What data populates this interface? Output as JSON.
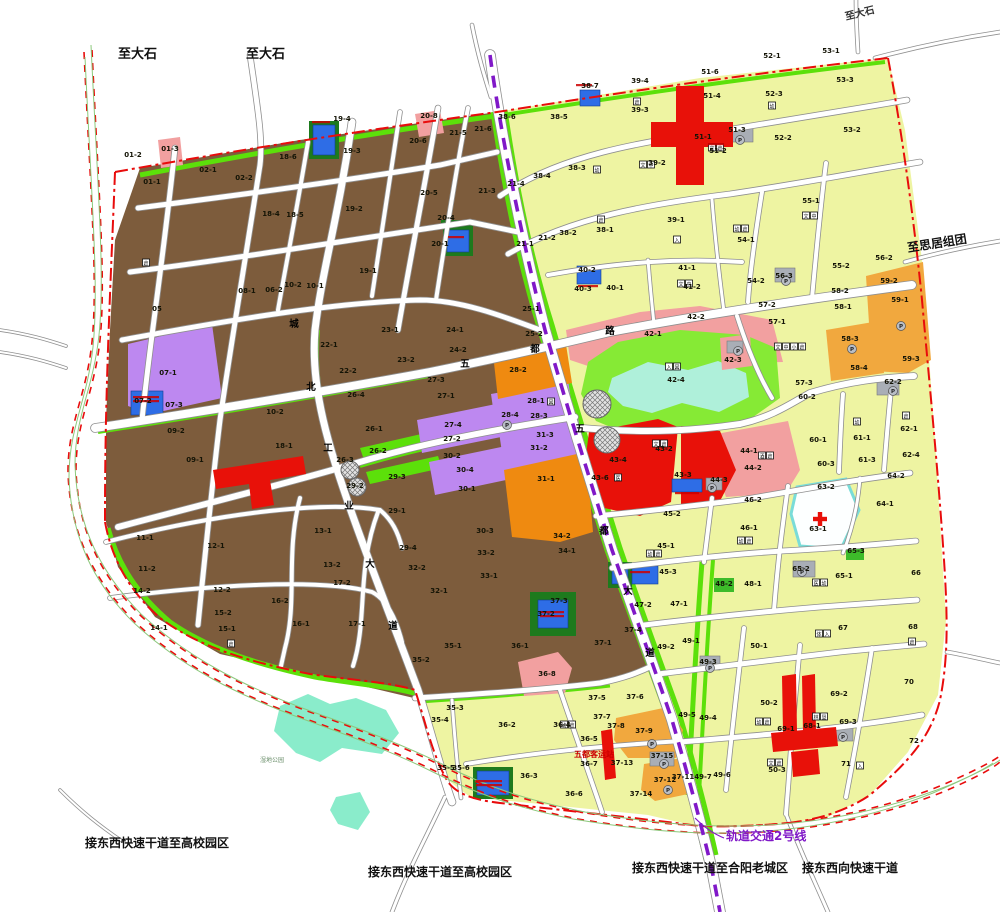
{
  "map_title": "城市控制性详细规划图",
  "colors": {
    "residential_brown": "#7d5c3c",
    "residential_yellow": "#eef4a2",
    "green_strip": "#5ce00a",
    "park_green": "#86ea35",
    "lake_cyan": "#aff0da",
    "wetland_cyan": "#8aeccb",
    "commercial_red": "#e81109",
    "orange_deep": "#ef8a10",
    "orange_light": "#f1a83e",
    "purple_parcel": "#bd88f0",
    "pink_parcel": "#f2a0a0",
    "blue_parcel": "#2e6de6",
    "gray_parcel": "#a9aeb6",
    "dark_green": "#1d7a1d",
    "hospital_white": "#fdffff",
    "hospital_border": "#7adcd8",
    "boundary_red": "#e80c0c",
    "rail_purple": "#8018c8",
    "road_casing": "#8f8f8f",
    "label_black": "#141406",
    "red_text": "#cc0000"
  },
  "exit_labels": [
    {
      "t": "至大石",
      "x": 118,
      "y": 58,
      "s": 13,
      "c": "#111",
      "r": 0
    },
    {
      "t": "至大石",
      "x": 246,
      "y": 58,
      "s": 13,
      "c": "#111",
      "r": 0
    },
    {
      "t": "至大石",
      "x": 846,
      "y": 20,
      "s": 10,
      "c": "#333",
      "r": -14
    },
    {
      "t": "至思居组团",
      "x": 908,
      "y": 252,
      "s": 12,
      "c": "#111",
      "r": -9
    },
    {
      "t": "接东西快速干道至高校园区",
      "x": 85,
      "y": 847,
      "s": 12,
      "c": "#111",
      "r": 0
    },
    {
      "t": "接东西快速干道至高校园区",
      "x": 368,
      "y": 876,
      "s": 12,
      "c": "#111",
      "r": 0
    },
    {
      "t": "接东西快速干道至合阳老城区",
      "x": 632,
      "y": 872,
      "s": 12,
      "c": "#111",
      "r": 0
    },
    {
      "t": "接东西向快速干道",
      "x": 802,
      "y": 872,
      "s": 12,
      "c": "#111",
      "r": 0
    }
  ],
  "rail_label": {
    "t": "轨道交通2号线",
    "x": 726,
    "y": 840,
    "s": 12,
    "c": "#8018c8"
  },
  "bus_station_label": {
    "t": "五都客运站",
    "x": 574,
    "y": 757,
    "s": 8,
    "c": "#cc0000"
  },
  "wetland_label": {
    "t": "湿地公园",
    "x": 260,
    "y": 762,
    "s": 6,
    "c": "#6b8f6b"
  },
  "road_name_chars": [
    {
      "t": "城",
      "x": 294,
      "y": 327
    },
    {
      "t": "北",
      "x": 311,
      "y": 390
    },
    {
      "t": "工",
      "x": 328,
      "y": 451
    },
    {
      "t": "业",
      "x": 349,
      "y": 509
    },
    {
      "t": "大",
      "x": 370,
      "y": 567
    },
    {
      "t": "道",
      "x": 393,
      "y": 629
    },
    {
      "t": "五",
      "x": 465,
      "y": 367
    },
    {
      "t": "都",
      "x": 535,
      "y": 352
    },
    {
      "t": "路",
      "x": 610,
      "y": 334
    },
    {
      "t": "五",
      "x": 580,
      "y": 432
    },
    {
      "t": "都",
      "x": 604,
      "y": 534
    },
    {
      "t": "大",
      "x": 628,
      "y": 594
    },
    {
      "t": "道",
      "x": 650,
      "y": 656
    }
  ],
  "parcel_labels": [
    {
      "t": "01-2",
      "x": 133,
      "y": 157
    },
    {
      "t": "01-3",
      "x": 170,
      "y": 151
    },
    {
      "t": "01-1",
      "x": 152,
      "y": 184
    },
    {
      "t": "02-1",
      "x": 208,
      "y": 172
    },
    {
      "t": "02-2",
      "x": 244,
      "y": 180
    },
    {
      "t": "18-6",
      "x": 288,
      "y": 159
    },
    {
      "t": "18-5",
      "x": 295,
      "y": 217
    },
    {
      "t": "18-4",
      "x": 271,
      "y": 216
    },
    {
      "t": "19-4",
      "x": 342,
      "y": 121
    },
    {
      "t": "19-3",
      "x": 352,
      "y": 153
    },
    {
      "t": "19-2",
      "x": 354,
      "y": 211
    },
    {
      "t": "19-1",
      "x": 368,
      "y": 273
    },
    {
      "t": "20-8",
      "x": 429,
      "y": 118
    },
    {
      "t": "20-6",
      "x": 418,
      "y": 143
    },
    {
      "t": "20-5",
      "x": 429,
      "y": 195
    },
    {
      "t": "20-4",
      "x": 446,
      "y": 220
    },
    {
      "t": "20-1",
      "x": 440,
      "y": 246
    },
    {
      "t": "21-5",
      "x": 458,
      "y": 135
    },
    {
      "t": "21-6",
      "x": 483,
      "y": 131
    },
    {
      "t": "21-3",
      "x": 487,
      "y": 193
    },
    {
      "t": "21-4",
      "x": 516,
      "y": 186
    },
    {
      "t": "21-1",
      "x": 525,
      "y": 246
    },
    {
      "t": "21-2",
      "x": 547,
      "y": 240
    },
    {
      "t": "05",
      "x": 157,
      "y": 311
    },
    {
      "t": "08-1",
      "x": 247,
      "y": 293
    },
    {
      "t": "06-2",
      "x": 274,
      "y": 292
    },
    {
      "t": "10-2",
      "x": 293,
      "y": 287
    },
    {
      "t": "10-1",
      "x": 315,
      "y": 288
    },
    {
      "t": "22-1",
      "x": 329,
      "y": 347
    },
    {
      "t": "22-2",
      "x": 348,
      "y": 373
    },
    {
      "t": "23-1",
      "x": 390,
      "y": 332
    },
    {
      "t": "23-2",
      "x": 406,
      "y": 362
    },
    {
      "t": "24-1",
      "x": 455,
      "y": 332
    },
    {
      "t": "24-2",
      "x": 458,
      "y": 352
    },
    {
      "t": "25-1",
      "x": 531,
      "y": 311
    },
    {
      "t": "25-2",
      "x": 534,
      "y": 336
    },
    {
      "t": "07-1",
      "x": 168,
      "y": 375
    },
    {
      "t": "07-2",
      "x": 143,
      "y": 403
    },
    {
      "t": "07-3",
      "x": 174,
      "y": 407
    },
    {
      "t": "09-2",
      "x": 176,
      "y": 433
    },
    {
      "t": "09-1",
      "x": 195,
      "y": 462
    },
    {
      "t": "10-2",
      "x": 275,
      "y": 414
    },
    {
      "t": "18-1",
      "x": 284,
      "y": 448
    },
    {
      "t": "26-4",
      "x": 356,
      "y": 397
    },
    {
      "t": "26-1",
      "x": 374,
      "y": 431
    },
    {
      "t": "26-2",
      "x": 378,
      "y": 453
    },
    {
      "t": "26-3",
      "x": 345,
      "y": 462
    },
    {
      "t": "29-3",
      "x": 397,
      "y": 479
    },
    {
      "t": "29-2",
      "x": 355,
      "y": 488
    },
    {
      "t": "27-3",
      "x": 436,
      "y": 382
    },
    {
      "t": "27-1",
      "x": 446,
      "y": 398
    },
    {
      "t": "27-4",
      "x": 453,
      "y": 427
    },
    {
      "t": "27-2",
      "x": 452,
      "y": 441
    },
    {
      "t": "28-2",
      "x": 518,
      "y": 372
    },
    {
      "t": "28-1",
      "x": 536,
      "y": 403
    },
    {
      "t": "28-4",
      "x": 510,
      "y": 417
    },
    {
      "t": "28-3",
      "x": 539,
      "y": 418
    },
    {
      "t": "31-3",
      "x": 545,
      "y": 437
    },
    {
      "t": "31-2",
      "x": 539,
      "y": 450
    },
    {
      "t": "30-2",
      "x": 452,
      "y": 458
    },
    {
      "t": "30-4",
      "x": 465,
      "y": 472
    },
    {
      "t": "30-1",
      "x": 467,
      "y": 491
    },
    {
      "t": "31-1",
      "x": 546,
      "y": 481
    },
    {
      "t": "30-3",
      "x": 485,
      "y": 533
    },
    {
      "t": "34-2",
      "x": 562,
      "y": 538
    },
    {
      "t": "29-1",
      "x": 397,
      "y": 513
    },
    {
      "t": "29-4",
      "x": 408,
      "y": 550
    },
    {
      "t": "32-2",
      "x": 417,
      "y": 570
    },
    {
      "t": "32-1",
      "x": 439,
      "y": 593
    },
    {
      "t": "33-2",
      "x": 486,
      "y": 555
    },
    {
      "t": "33-1",
      "x": 489,
      "y": 578
    },
    {
      "t": "34-1",
      "x": 567,
      "y": 553
    },
    {
      "t": "11-1",
      "x": 145,
      "y": 540
    },
    {
      "t": "11-2",
      "x": 147,
      "y": 571
    },
    {
      "t": "12-1",
      "x": 216,
      "y": 548
    },
    {
      "t": "12-2",
      "x": 222,
      "y": 592
    },
    {
      "t": "13-1",
      "x": 323,
      "y": 533
    },
    {
      "t": "13-2",
      "x": 332,
      "y": 567
    },
    {
      "t": "14-2",
      "x": 142,
      "y": 593
    },
    {
      "t": "14-1",
      "x": 159,
      "y": 630
    },
    {
      "t": "15-2",
      "x": 223,
      "y": 615
    },
    {
      "t": "15-1",
      "x": 227,
      "y": 631
    },
    {
      "t": "16-2",
      "x": 280,
      "y": 603
    },
    {
      "t": "16-1",
      "x": 301,
      "y": 626
    },
    {
      "t": "17-2",
      "x": 342,
      "y": 585
    },
    {
      "t": "17-1",
      "x": 357,
      "y": 626
    },
    {
      "t": "35-1",
      "x": 453,
      "y": 648
    },
    {
      "t": "35-2",
      "x": 421,
      "y": 662
    },
    {
      "t": "36-1",
      "x": 520,
      "y": 648
    },
    {
      "t": "37-1",
      "x": 603,
      "y": 645
    },
    {
      "t": "37-3",
      "x": 559,
      "y": 603
    },
    {
      "t": "37-2",
      "x": 546,
      "y": 616
    },
    {
      "t": "36-8",
      "x": 547,
      "y": 676
    },
    {
      "t": "35-3",
      "x": 455,
      "y": 710
    },
    {
      "t": "35-4",
      "x": 440,
      "y": 722
    },
    {
      "t": "36-2",
      "x": 507,
      "y": 727
    },
    {
      "t": "35-5",
      "x": 446,
      "y": 770
    },
    {
      "t": "35-6",
      "x": 461,
      "y": 770
    },
    {
      "t": "36-3",
      "x": 529,
      "y": 778
    },
    {
      "t": "36-4",
      "x": 562,
      "y": 727
    },
    {
      "t": "37-5",
      "x": 597,
      "y": 700
    },
    {
      "t": "37-6",
      "x": 635,
      "y": 699
    },
    {
      "t": "37-7",
      "x": 602,
      "y": 719
    },
    {
      "t": "37-8",
      "x": 616,
      "y": 728
    },
    {
      "t": "37-9",
      "x": 644,
      "y": 733
    },
    {
      "t": "36-5",
      "x": 589,
      "y": 741
    },
    {
      "t": "36-7",
      "x": 589,
      "y": 766
    },
    {
      "t": "36-6",
      "x": 574,
      "y": 796
    },
    {
      "t": "37-14",
      "x": 641,
      "y": 796
    },
    {
      "t": "37-13",
      "x": 622,
      "y": 765
    },
    {
      "t": "37-15",
      "x": 662,
      "y": 758
    },
    {
      "t": "37-12",
      "x": 665,
      "y": 782
    },
    {
      "t": "37-11",
      "x": 683,
      "y": 779
    },
    {
      "t": "37-4",
      "x": 633,
      "y": 632
    },
    {
      "t": "38-6",
      "x": 507,
      "y": 119
    },
    {
      "t": "38-5",
      "x": 559,
      "y": 119
    },
    {
      "t": "38-7",
      "x": 590,
      "y": 88
    },
    {
      "t": "39-4",
      "x": 640,
      "y": 83
    },
    {
      "t": "39-3",
      "x": 640,
      "y": 112
    },
    {
      "t": "51-6",
      "x": 710,
      "y": 74
    },
    {
      "t": "51-4",
      "x": 712,
      "y": 98
    },
    {
      "t": "51-3",
      "x": 737,
      "y": 132
    },
    {
      "t": "51-2",
      "x": 718,
      "y": 153
    },
    {
      "t": "51-1",
      "x": 703,
      "y": 139
    },
    {
      "t": "52-1",
      "x": 772,
      "y": 58
    },
    {
      "t": "52-3",
      "x": 774,
      "y": 96
    },
    {
      "t": "52-2",
      "x": 783,
      "y": 140
    },
    {
      "t": "53-1",
      "x": 831,
      "y": 53
    },
    {
      "t": "53-3",
      "x": 845,
      "y": 82
    },
    {
      "t": "53-2",
      "x": 852,
      "y": 132
    },
    {
      "t": "38-3",
      "x": 577,
      "y": 170
    },
    {
      "t": "38-4",
      "x": 542,
      "y": 178
    },
    {
      "t": "39-2",
      "x": 657,
      "y": 165
    },
    {
      "t": "38-2",
      "x": 568,
      "y": 235
    },
    {
      "t": "38-1",
      "x": 605,
      "y": 232
    },
    {
      "t": "39-1",
      "x": 676,
      "y": 222
    },
    {
      "t": "54-1",
      "x": 746,
      "y": 242
    },
    {
      "t": "55-1",
      "x": 811,
      "y": 203
    },
    {
      "t": "40-2",
      "x": 587,
      "y": 272
    },
    {
      "t": "40-3",
      "x": 583,
      "y": 291
    },
    {
      "t": "40-1",
      "x": 615,
      "y": 290
    },
    {
      "t": "41-1",
      "x": 687,
      "y": 270
    },
    {
      "t": "41-2",
      "x": 692,
      "y": 289
    },
    {
      "t": "54-2",
      "x": 756,
      "y": 283
    },
    {
      "t": "55-2",
      "x": 841,
      "y": 268
    },
    {
      "t": "56-2",
      "x": 884,
      "y": 260
    },
    {
      "t": "56-3",
      "x": 784,
      "y": 278
    },
    {
      "t": "58-2",
      "x": 840,
      "y": 293
    },
    {
      "t": "58-1",
      "x": 843,
      "y": 309
    },
    {
      "t": "58-3",
      "x": 850,
      "y": 341
    },
    {
      "t": "58-4",
      "x": 859,
      "y": 370
    },
    {
      "t": "59-2",
      "x": 889,
      "y": 283
    },
    {
      "t": "59-1",
      "x": 900,
      "y": 302
    },
    {
      "t": "59-3",
      "x": 911,
      "y": 361
    },
    {
      "t": "57-2",
      "x": 767,
      "y": 307
    },
    {
      "t": "57-1",
      "x": 777,
      "y": 324
    },
    {
      "t": "57-3",
      "x": 804,
      "y": 385
    },
    {
      "t": "60-2",
      "x": 807,
      "y": 399
    },
    {
      "t": "62-2",
      "x": 893,
      "y": 384
    },
    {
      "t": "60-1",
      "x": 818,
      "y": 442
    },
    {
      "t": "61-1",
      "x": 862,
      "y": 440
    },
    {
      "t": "62-1",
      "x": 909,
      "y": 431
    },
    {
      "t": "60-3",
      "x": 826,
      "y": 466
    },
    {
      "t": "61-3",
      "x": 867,
      "y": 462
    },
    {
      "t": "62-4",
      "x": 911,
      "y": 457
    },
    {
      "t": "42-2",
      "x": 696,
      "y": 319
    },
    {
      "t": "42-1",
      "x": 653,
      "y": 336
    },
    {
      "t": "42-3",
      "x": 733,
      "y": 362
    },
    {
      "t": "42-4",
      "x": 676,
      "y": 382
    },
    {
      "t": "43-2",
      "x": 664,
      "y": 451
    },
    {
      "t": "43-4",
      "x": 618,
      "y": 462
    },
    {
      "t": "43-6",
      "x": 600,
      "y": 480
    },
    {
      "t": "43-3",
      "x": 683,
      "y": 477
    },
    {
      "t": "44-3",
      "x": 719,
      "y": 482
    },
    {
      "t": "44-1",
      "x": 749,
      "y": 453
    },
    {
      "t": "44-2",
      "x": 753,
      "y": 470
    },
    {
      "t": "45-2",
      "x": 672,
      "y": 516
    },
    {
      "t": "45-1",
      "x": 666,
      "y": 548
    },
    {
      "t": "45-3",
      "x": 668,
      "y": 574
    },
    {
      "t": "46-2",
      "x": 753,
      "y": 502
    },
    {
      "t": "46-1",
      "x": 749,
      "y": 530
    },
    {
      "t": "63-2",
      "x": 826,
      "y": 489
    },
    {
      "t": "64-2",
      "x": 896,
      "y": 478
    },
    {
      "t": "64-1",
      "x": 885,
      "y": 506
    },
    {
      "t": "63-1",
      "x": 818,
      "y": 531
    },
    {
      "t": "65-3",
      "x": 856,
      "y": 553
    },
    {
      "t": "65-2",
      "x": 801,
      "y": 571
    },
    {
      "t": "65-1",
      "x": 844,
      "y": 578
    },
    {
      "t": "66",
      "x": 916,
      "y": 575
    },
    {
      "t": "48-2",
      "x": 724,
      "y": 586
    },
    {
      "t": "48-1",
      "x": 753,
      "y": 586
    },
    {
      "t": "47-1",
      "x": 679,
      "y": 606
    },
    {
      "t": "47-2",
      "x": 643,
      "y": 607
    },
    {
      "t": "49-1",
      "x": 691,
      "y": 643
    },
    {
      "t": "49-2",
      "x": 666,
      "y": 649
    },
    {
      "t": "49-3",
      "x": 708,
      "y": 664
    },
    {
      "t": "49-5",
      "x": 687,
      "y": 717
    },
    {
      "t": "49-4",
      "x": 708,
      "y": 720
    },
    {
      "t": "49-7",
      "x": 703,
      "y": 779
    },
    {
      "t": "49-6",
      "x": 722,
      "y": 777
    },
    {
      "t": "50-1",
      "x": 759,
      "y": 648
    },
    {
      "t": "50-2",
      "x": 769,
      "y": 705
    },
    {
      "t": "50-3",
      "x": 777,
      "y": 772
    },
    {
      "t": "67",
      "x": 843,
      "y": 630
    },
    {
      "t": "68",
      "x": 913,
      "y": 629
    },
    {
      "t": "69-2",
      "x": 839,
      "y": 696
    },
    {
      "t": "69-1",
      "x": 786,
      "y": 731
    },
    {
      "t": "68-1",
      "x": 812,
      "y": 728
    },
    {
      "t": "69-3",
      "x": 848,
      "y": 724
    },
    {
      "t": "70",
      "x": 909,
      "y": 684
    },
    {
      "t": "71",
      "x": 846,
      "y": 766
    },
    {
      "t": "72",
      "x": 914,
      "y": 743
    }
  ],
  "facility_icons": [
    {
      "x": 597,
      "y": 172,
      "ch": "幼"
    },
    {
      "x": 637,
      "y": 104,
      "ch": "倉"
    },
    {
      "x": 643,
      "y": 167,
      "ch": "文中"
    },
    {
      "x": 601,
      "y": 222,
      "ch": "倉"
    },
    {
      "x": 677,
      "y": 242,
      "ch": "入"
    },
    {
      "x": 712,
      "y": 150,
      "ch": "文倉"
    },
    {
      "x": 772,
      "y": 108,
      "ch": "幼"
    },
    {
      "x": 737,
      "y": 231,
      "ch": "幼倉"
    },
    {
      "x": 806,
      "y": 218,
      "ch": "文中"
    },
    {
      "x": 681,
      "y": 286,
      "ch": "文中"
    },
    {
      "x": 778,
      "y": 349,
      "ch": "文中小倉"
    },
    {
      "x": 857,
      "y": 424,
      "ch": "幼"
    },
    {
      "x": 906,
      "y": 418,
      "ch": "倉"
    },
    {
      "x": 762,
      "y": 458,
      "ch": "酒倉"
    },
    {
      "x": 741,
      "y": 543,
      "ch": "幼倉"
    },
    {
      "x": 650,
      "y": 556,
      "ch": "幼倉"
    },
    {
      "x": 816,
      "y": 585,
      "ch": "医幼"
    },
    {
      "x": 819,
      "y": 636,
      "ch": "体入"
    },
    {
      "x": 912,
      "y": 644,
      "ch": "倉"
    },
    {
      "x": 860,
      "y": 768,
      "ch": "入"
    },
    {
      "x": 771,
      "y": 765,
      "ch": "文倉"
    },
    {
      "x": 759,
      "y": 724,
      "ch": "幼倉"
    },
    {
      "x": 816,
      "y": 719,
      "ch": "林垦"
    },
    {
      "x": 551,
      "y": 404,
      "ch": "図"
    },
    {
      "x": 656,
      "y": 446,
      "ch": "文倉"
    },
    {
      "x": 618,
      "y": 480,
      "ch": "医"
    },
    {
      "x": 669,
      "y": 369,
      "ch": "入図"
    },
    {
      "x": 564,
      "y": 727,
      "ch": "幼倉"
    },
    {
      "x": 146,
      "y": 265,
      "ch": "倉"
    },
    {
      "x": 231,
      "y": 646,
      "ch": "倉"
    }
  ],
  "parking_marks": [
    [
      507,
      425
    ],
    [
      738,
      351
    ],
    [
      712,
      488
    ],
    [
      710,
      668
    ],
    [
      786,
      281
    ],
    [
      893,
      391
    ],
    [
      802,
      572
    ],
    [
      843,
      737
    ],
    [
      740,
      140
    ],
    [
      664,
      764
    ],
    [
      852,
      349
    ],
    [
      901,
      326
    ],
    [
      652,
      744
    ],
    [
      668,
      790
    ]
  ],
  "metro_stations": [
    [
      597,
      404,
      14
    ],
    [
      607,
      440,
      13
    ],
    [
      350,
      470,
      9
    ],
    [
      357,
      487,
      9
    ]
  ],
  "hospital_cross": [
    820,
    519
  ],
  "red_text_smudges": [
    [
      576,
      84,
      16,
      1
    ],
    [
      312,
      121,
      18,
      1
    ],
    [
      448,
      236,
      16,
      1
    ],
    [
      133,
      396,
      26,
      2
    ],
    [
      578,
      285,
      20,
      1
    ],
    [
      675,
      492,
      24,
      1
    ],
    [
      540,
      611,
      24,
      2
    ],
    [
      476,
      780,
      26,
      2
    ],
    [
      630,
      571,
      20,
      1
    ],
    [
      708,
      143,
      16,
      1
    ]
  ]
}
